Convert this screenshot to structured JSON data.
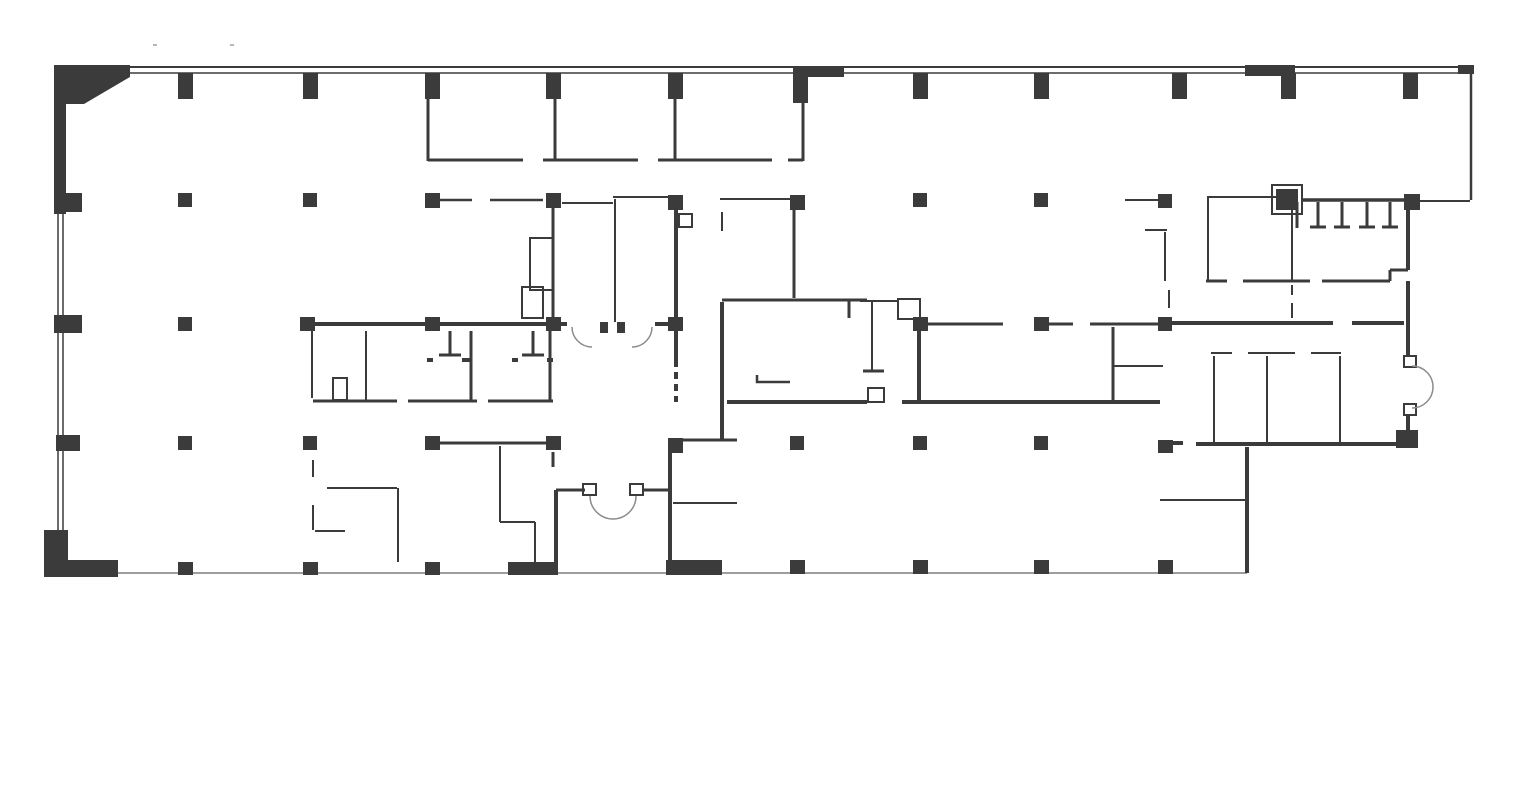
{
  "plan": {
    "canvas": {
      "width": 1532,
      "height": 789,
      "background": "#ffffff"
    },
    "colors": {
      "wall": "#3b3b3b",
      "light": "#9e9e9e",
      "door": "#8c8c8c"
    },
    "corner_polygon": "54,65 130,65 130,77 84,104 66,104 66,214 54,214",
    "wall_blocks": [
      [
        44,
        530,
        24,
        47
      ],
      [
        55,
        560,
        63,
        17
      ],
      [
        806,
        66,
        38,
        11
      ],
      [
        1245,
        65,
        50,
        11
      ],
      [
        1458,
        65,
        16,
        9
      ],
      [
        508,
        562,
        50,
        13
      ],
      [
        666,
        560,
        56,
        15
      ],
      [
        1396,
        430,
        22,
        18
      ],
      [
        600,
        322,
        8,
        11
      ],
      [
        617,
        322,
        8,
        11
      ]
    ],
    "columns": [
      [
        178,
        73,
        15,
        26
      ],
      [
        303,
        73,
        15,
        26
      ],
      [
        425,
        73,
        15,
        26
      ],
      [
        546,
        73,
        15,
        26
      ],
      [
        668,
        73,
        15,
        26
      ],
      [
        793,
        66,
        15,
        37
      ],
      [
        913,
        73,
        15,
        26
      ],
      [
        1034,
        73,
        15,
        26
      ],
      [
        1172,
        73,
        15,
        26
      ],
      [
        1281,
        73,
        15,
        26
      ],
      [
        1403,
        73,
        15,
        26
      ],
      [
        54,
        193,
        28,
        19
      ],
      [
        178,
        193,
        14,
        14
      ],
      [
        303,
        193,
        14,
        14
      ],
      [
        425,
        193,
        15,
        15
      ],
      [
        546,
        193,
        15,
        15
      ],
      [
        668,
        195,
        15,
        15
      ],
      [
        790,
        195,
        15,
        15
      ],
      [
        913,
        193,
        14,
        14
      ],
      [
        1034,
        193,
        14,
        14
      ],
      [
        1158,
        194,
        14,
        14
      ],
      [
        1276,
        189,
        22,
        21
      ],
      [
        1404,
        194,
        16,
        16
      ],
      [
        54,
        315,
        28,
        18
      ],
      [
        178,
        317,
        14,
        14
      ],
      [
        300,
        317,
        15,
        14
      ],
      [
        425,
        317,
        15,
        14
      ],
      [
        546,
        317,
        15,
        14
      ],
      [
        668,
        317,
        15,
        14
      ],
      [
        913,
        317,
        15,
        14
      ],
      [
        1034,
        317,
        15,
        14
      ],
      [
        1158,
        317,
        14,
        14
      ],
      [
        56,
        435,
        24,
        16
      ],
      [
        178,
        436,
        14,
        14
      ],
      [
        303,
        436,
        14,
        14
      ],
      [
        425,
        436,
        15,
        14
      ],
      [
        546,
        436,
        15,
        14
      ],
      [
        668,
        438,
        15,
        15
      ],
      [
        790,
        436,
        14,
        14
      ],
      [
        913,
        436,
        14,
        14
      ],
      [
        1034,
        436,
        14,
        14
      ],
      [
        1158,
        440,
        15,
        13
      ],
      [
        178,
        562,
        15,
        13
      ],
      [
        303,
        562,
        15,
        13
      ],
      [
        425,
        562,
        15,
        13
      ],
      [
        790,
        560,
        15,
        14
      ],
      [
        913,
        560,
        15,
        14
      ],
      [
        1034,
        560,
        15,
        14
      ],
      [
        1158,
        560,
        15,
        14
      ]
    ],
    "wall_lines": [
      [
        130,
        67,
        1470,
        67,
        2
      ],
      [
        130,
        73,
        1470,
        73,
        1.5
      ],
      [
        1471,
        66,
        1471,
        200,
        2.5
      ],
      [
        58,
        214,
        58,
        532,
        1.5
      ],
      [
        63,
        214,
        63,
        532,
        1.5
      ],
      [
        428,
        99,
        428,
        161,
        3
      ],
      [
        555,
        99,
        555,
        161,
        3
      ],
      [
        675,
        99,
        675,
        161,
        3
      ],
      [
        803,
        77,
        803,
        161,
        3
      ],
      [
        428,
        160,
        523,
        160,
        3
      ],
      [
        543,
        160,
        638,
        160,
        3
      ],
      [
        658,
        160,
        772,
        160,
        3
      ],
      [
        788,
        160,
        803,
        160,
        3
      ],
      [
        440,
        200,
        472,
        200,
        2.5
      ],
      [
        490,
        200,
        543,
        200,
        2.5
      ],
      [
        553,
        208,
        553,
        318,
        3
      ],
      [
        615,
        199,
        615,
        322,
        2
      ],
      [
        613,
        197,
        673,
        197,
        2
      ],
      [
        562,
        203,
        613,
        203,
        2
      ],
      [
        676,
        210,
        676,
        367,
        4
      ],
      [
        676,
        372,
        676,
        379,
        4
      ],
      [
        676,
        384,
        676,
        391,
        4
      ],
      [
        676,
        396,
        676,
        402,
        4
      ],
      [
        720,
        199,
        790,
        199,
        2
      ],
      [
        722,
        212,
        722,
        231,
        2
      ],
      [
        794,
        210,
        794,
        298,
        3
      ],
      [
        722,
        300,
        867,
        300,
        3
      ],
      [
        849,
        300,
        849,
        318,
        3
      ],
      [
        860,
        301,
        898,
        301,
        2
      ],
      [
        872,
        301,
        872,
        371,
        2
      ],
      [
        863,
        371,
        884,
        371,
        3
      ],
      [
        722,
        302,
        722,
        441,
        4
      ],
      [
        683,
        440,
        737,
        440,
        3
      ],
      [
        673,
        503,
        737,
        503,
        2
      ],
      [
        670,
        453,
        670,
        561,
        4
      ],
      [
        553,
        452,
        553,
        467,
        3
      ],
      [
        556,
        490,
        556,
        570,
        4
      ],
      [
        556,
        490,
        585,
        490,
        3
      ],
      [
        643,
        490,
        672,
        490,
        3
      ],
      [
        927,
        324,
        1003,
        324,
        3
      ],
      [
        1048,
        324,
        1073,
        324,
        3
      ],
      [
        1090,
        324,
        1160,
        324,
        3
      ],
      [
        919,
        331,
        919,
        400,
        4
      ],
      [
        1113,
        327,
        1113,
        401,
        3
      ],
      [
        1113,
        366,
        1163,
        366,
        2
      ],
      [
        902,
        402,
        1160,
        402,
        4
      ],
      [
        727,
        402,
        867,
        402,
        4
      ],
      [
        313,
        324,
        567,
        324,
        4
      ],
      [
        655,
        324,
        683,
        324,
        4
      ],
      [
        312,
        331,
        312,
        398,
        2
      ],
      [
        366,
        331,
        366,
        400,
        2
      ],
      [
        450,
        331,
        450,
        355,
        3
      ],
      [
        439,
        355,
        461,
        355,
        3
      ],
      [
        427,
        360,
        433,
        360,
        4
      ],
      [
        462,
        360,
        470,
        360,
        4
      ],
      [
        471,
        331,
        471,
        400,
        3
      ],
      [
        533,
        331,
        533,
        355,
        3
      ],
      [
        522,
        355,
        544,
        355,
        3
      ],
      [
        512,
        360,
        518,
        360,
        4
      ],
      [
        547,
        360,
        553,
        360,
        4
      ],
      [
        550,
        331,
        550,
        400,
        3
      ],
      [
        313,
        401,
        397,
        401,
        3
      ],
      [
        408,
        401,
        477,
        401,
        3
      ],
      [
        488,
        401,
        553,
        401,
        3
      ],
      [
        440,
        443,
        546,
        443,
        3
      ],
      [
        500,
        446,
        500,
        522,
        2
      ],
      [
        500,
        522,
        535,
        522,
        2
      ],
      [
        535,
        522,
        535,
        563,
        2
      ],
      [
        313,
        460,
        313,
        477,
        2
      ],
      [
        313,
        505,
        313,
        530,
        2
      ],
      [
        327,
        488,
        397,
        488,
        2
      ],
      [
        398,
        488,
        398,
        562,
        2
      ],
      [
        315,
        531,
        345,
        531,
        2
      ],
      [
        1125,
        200,
        1158,
        200,
        2
      ],
      [
        1207,
        197,
        1277,
        197,
        2
      ],
      [
        1302,
        200,
        1404,
        200,
        3.5
      ],
      [
        1420,
        201,
        1470,
        201,
        2
      ],
      [
        1297,
        202,
        1297,
        228,
        3
      ],
      [
        1318,
        202,
        1318,
        226,
        3
      ],
      [
        1310,
        227,
        1326,
        227,
        3
      ],
      [
        1342,
        202,
        1342,
        226,
        3
      ],
      [
        1334,
        227,
        1350,
        227,
        3
      ],
      [
        1367,
        202,
        1367,
        226,
        3
      ],
      [
        1359,
        227,
        1375,
        227,
        3
      ],
      [
        1390,
        202,
        1390,
        226,
        3
      ],
      [
        1382,
        227,
        1398,
        227,
        3
      ],
      [
        1208,
        198,
        1208,
        281,
        2
      ],
      [
        1292,
        210,
        1292,
        281,
        2
      ],
      [
        1206,
        281,
        1227,
        281,
        3
      ],
      [
        1243,
        281,
        1310,
        281,
        3
      ],
      [
        1322,
        281,
        1390,
        281,
        3
      ],
      [
        1408,
        208,
        1408,
        270,
        4
      ],
      [
        1390,
        270,
        1408,
        270,
        3
      ],
      [
        1390,
        270,
        1390,
        281,
        3
      ],
      [
        1408,
        281,
        1408,
        357,
        4
      ],
      [
        1408,
        415,
        1408,
        434,
        4
      ],
      [
        1170,
        323,
        1333,
        323,
        4
      ],
      [
        1352,
        323,
        1404,
        323,
        4
      ],
      [
        1292,
        285,
        1292,
        295,
        2
      ],
      [
        1292,
        303,
        1292,
        318,
        2
      ],
      [
        1145,
        230,
        1167,
        230,
        2
      ],
      [
        1165,
        232,
        1165,
        281,
        2
      ],
      [
        1169,
        290,
        1169,
        308,
        2
      ],
      [
        1211,
        353,
        1232,
        353,
        2
      ],
      [
        1248,
        353,
        1295,
        353,
        2
      ],
      [
        1311,
        353,
        1341,
        353,
        2
      ],
      [
        1214,
        356,
        1214,
        442,
        2
      ],
      [
        1267,
        356,
        1267,
        442,
        2
      ],
      [
        1340,
        356,
        1340,
        442,
        2
      ],
      [
        1160,
        500,
        1245,
        500,
        2
      ],
      [
        1247,
        447,
        1247,
        573,
        4
      ],
      [
        1196,
        444,
        1398,
        444,
        4
      ],
      [
        1173,
        443,
        1183,
        443,
        4
      ]
    ],
    "light_lines": [
      [
        118,
        573,
        1247,
        573,
        2
      ],
      [
        153,
        45,
        157,
        45,
        1.5
      ],
      [
        230,
        45,
        234,
        45,
        1.5
      ]
    ],
    "outline_boxes": [
      [
        1272,
        185,
        30,
        29
      ],
      [
        679,
        214,
        13,
        13
      ],
      [
        583,
        484,
        13,
        11
      ],
      [
        630,
        484,
        13,
        11
      ],
      [
        1404,
        356,
        12,
        11
      ],
      [
        1404,
        404,
        12,
        11
      ],
      [
        868,
        388,
        16,
        14
      ],
      [
        530,
        238,
        23,
        52
      ],
      [
        522,
        287,
        21,
        31
      ],
      [
        898,
        299,
        22,
        20
      ],
      [
        333,
        378,
        14,
        22
      ]
    ],
    "fixture_paths": [
      "M757,375 L757,382 L790,382"
    ],
    "door_paths": [
      "M590,496 A23,23 0 0 0 613,519",
      "M636,496 A23,23 0 0 1 613,519",
      "M1412,366 A21,21 0 0 1 1433,387",
      "M1412,408 A21,21 0 0 0 1433,387",
      "M572,327 A20,20 0 0 0 592,347",
      "M652,327 A20,20 0 0 1 632,347"
    ]
  }
}
